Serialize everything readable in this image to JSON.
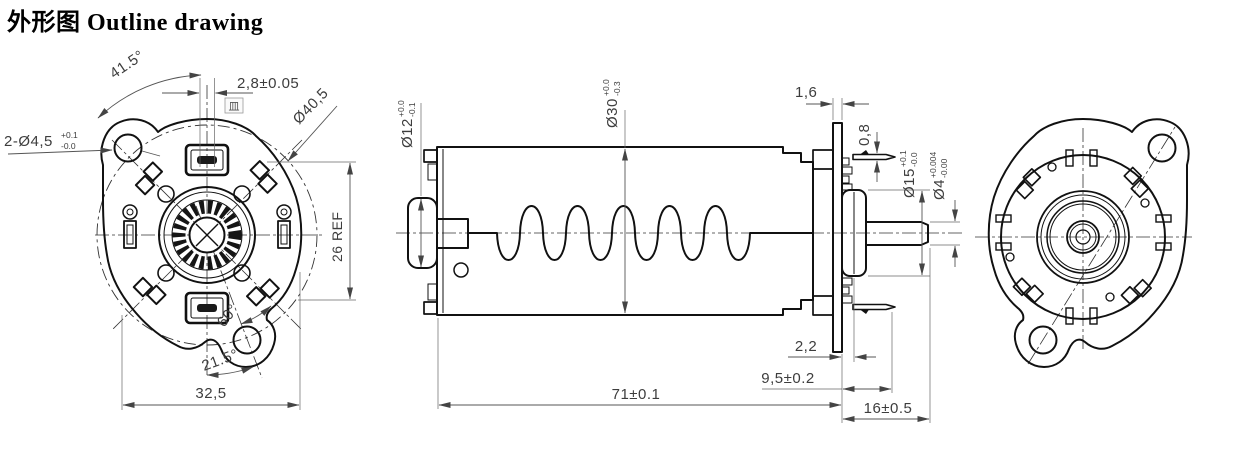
{
  "title": "外形图 Outline drawing",
  "front_view": {
    "angle_top": "41.5°",
    "slot_width": "2,8±0.05",
    "datum_symbol": "皿",
    "bolt_circle_dia": "Ø40,5",
    "mount_holes": "2-Ø4,5",
    "mount_holes_tol_upper": "+0.1",
    "mount_holes_tol_lower": "-0.0",
    "height_ref": "26 REF",
    "angle_ear": "60°",
    "angle_bottom": "21.5°",
    "width": "32,5"
  },
  "side_view": {
    "front_boss_dia": "Ø12",
    "front_boss_tol_upper": "+0.0",
    "front_boss_tol_lower": "-0.1",
    "body_dia": "Ø30",
    "body_dia_tol_upper": "+0.0",
    "body_dia_tol_lower": "-0.3",
    "plate_thickness": "1,6",
    "terminal_thickness": "0,8",
    "rear_boss_dia": "Ø15",
    "rear_boss_tol_upper": "+0.1",
    "rear_boss_tol_lower": "-0.0",
    "shaft_dia": "Ø4",
    "shaft_dia_tol_upper": "+0.004",
    "shaft_dia_tol_lower": "-0.00",
    "plate_to_step": "2,2",
    "plate_to_terminal": "9,5±0.2",
    "body_length": "71±0.1",
    "rear_length": "16±0.5"
  }
}
